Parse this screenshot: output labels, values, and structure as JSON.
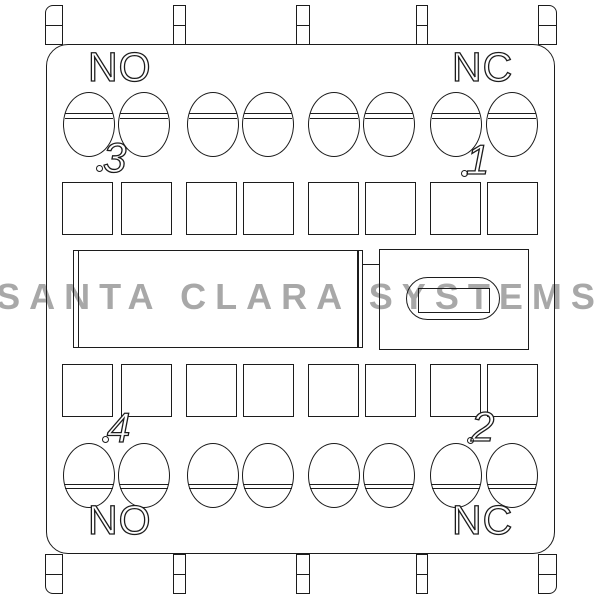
{
  "watermark": {
    "text": "SANTA CLARA SYSTEMS",
    "color": "#a8a8a8"
  },
  "contact_labels": {
    "top_left": "NO",
    "top_right": "NC",
    "bottom_left": "NO",
    "bottom_right": "NC"
  },
  "terminal_numbers": {
    "top_left": "3",
    "top_right": "1",
    "bottom_left": "4",
    "bottom_right": "2"
  },
  "structure": {
    "mounting_tabs_top": 5,
    "mounting_tabs_bottom": 5,
    "screw_terminals_top_row": 8,
    "screw_terminals_bottom_row": 8,
    "terminal_openings_top_row": 8,
    "terminal_openings_bottom_row": 8
  },
  "colors": {
    "line": "#1c1c1c",
    "background": "#ffffff",
    "watermark": "#a8a8a8"
  }
}
